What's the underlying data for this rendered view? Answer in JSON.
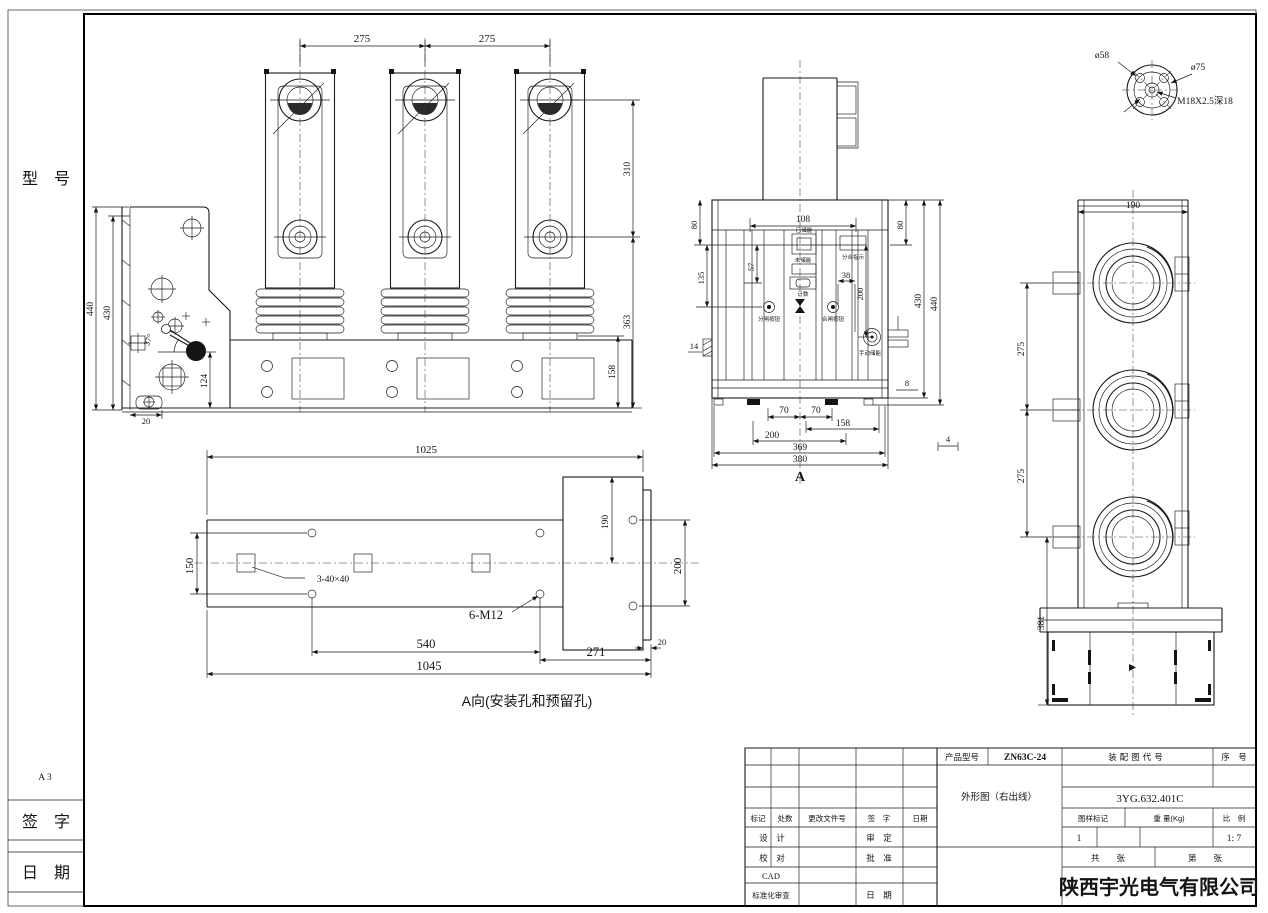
{
  "margin": {
    "model": "型　号",
    "format": "A 3",
    "sign": "签　字",
    "date": "日　期"
  },
  "front": {
    "span1": "275",
    "span2": "275",
    "d310": "310",
    "d363": "363",
    "d158": "158"
  },
  "side": {
    "d440": "440",
    "d430": "430",
    "angle": "37°",
    "d124": "124",
    "d20": "20"
  },
  "section": {
    "d108": "108",
    "d80l": "80",
    "d80r": "80",
    "d57": "57",
    "d135": "135",
    "d38": "38",
    "d200": "200",
    "d430": "430",
    "d440": "440",
    "d14": "14",
    "d8": "8",
    "d4": "4",
    "d70a": "70",
    "d70b": "70",
    "d158": "158",
    "d200b": "200",
    "d369": "369",
    "d380": "380",
    "view_label": "A",
    "charged": "已储能",
    "discharged": "未储能",
    "counter": "计数",
    "indicator": "分合指示",
    "open_btn": "分闸按钮",
    "close_btn": "合闸按钮",
    "manual": "手动储能"
  },
  "detail": {
    "d58": "ø58",
    "d75": "ø75",
    "thread": "M18X2.5深18"
  },
  "right": {
    "d190": "190",
    "span1": "275",
    "span2": "275",
    "d381": "381"
  },
  "plan": {
    "d1025": "1025",
    "d150": "150",
    "d190": "190",
    "d200": "200",
    "sq": "3-40×40",
    "th": "6-M12",
    "d540": "540",
    "d271": "271",
    "d20": "20",
    "d1045": "1045",
    "caption": "A向(安装孔和预留孔)"
  },
  "tb": {
    "product_label": "产品型号",
    "product": "ZN63C-24",
    "assembly_label": "装配图代号",
    "serial_label": "序　号",
    "name": "外形图（右出线）",
    "code": "3YG.632.401C",
    "mark": "标记",
    "count": "处数",
    "change_doc": "更改文件号",
    "sign": "签　字",
    "date": "日期",
    "design": "设　计",
    "review": "审　定",
    "check": "校　对",
    "approve": "批　准",
    "cad": "CAD",
    "std": "标准化审查",
    "date2": "日　期",
    "stamp_label": "图样标记",
    "weight_label": "重 量(Kg)",
    "scale_label": "比　例",
    "stamp": "1",
    "scale": "1: 7",
    "total": "共　　张",
    "page": "第　　张",
    "company": "陕西宇光电气有限公司"
  }
}
